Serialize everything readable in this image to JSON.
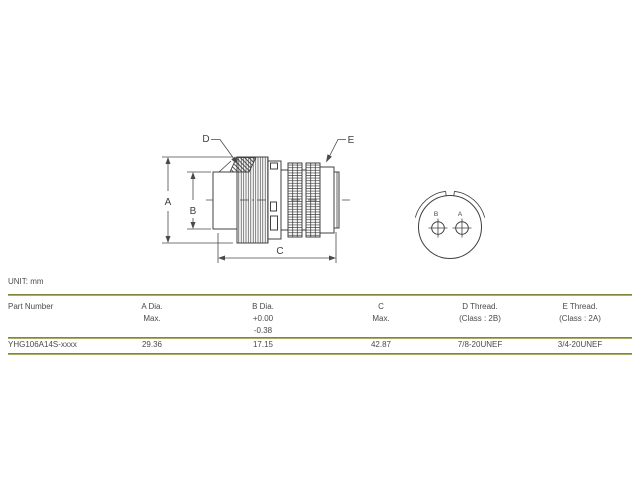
{
  "unit_label": "UNIT: mm",
  "drawing": {
    "dim_labels": {
      "a": "A",
      "b": "B",
      "c": "C",
      "d": "D",
      "e": "E"
    },
    "front_view": {
      "pin_left": "B",
      "pin_right": "A"
    }
  },
  "table": {
    "columns": [
      {
        "header_lines": [
          "Part Number",
          "",
          ""
        ],
        "value": "YHG106A14S-xxxx"
      },
      {
        "header_lines": [
          "A Dia.",
          "Max.",
          ""
        ],
        "value": "29.36"
      },
      {
        "header_lines": [
          "B Dia.",
          "+0.00",
          "-0.38"
        ],
        "value": "17.15"
      },
      {
        "header_lines": [
          "C",
          "Max.",
          ""
        ],
        "value": "42.87"
      },
      {
        "header_lines": [
          "D Thread.",
          "(Class : 2B)",
          ""
        ],
        "value": "7/8-20UNEF"
      },
      {
        "header_lines": [
          "E Thread.",
          "(Class : 2A)",
          ""
        ],
        "value": "3/4-20UNEF"
      }
    ]
  }
}
